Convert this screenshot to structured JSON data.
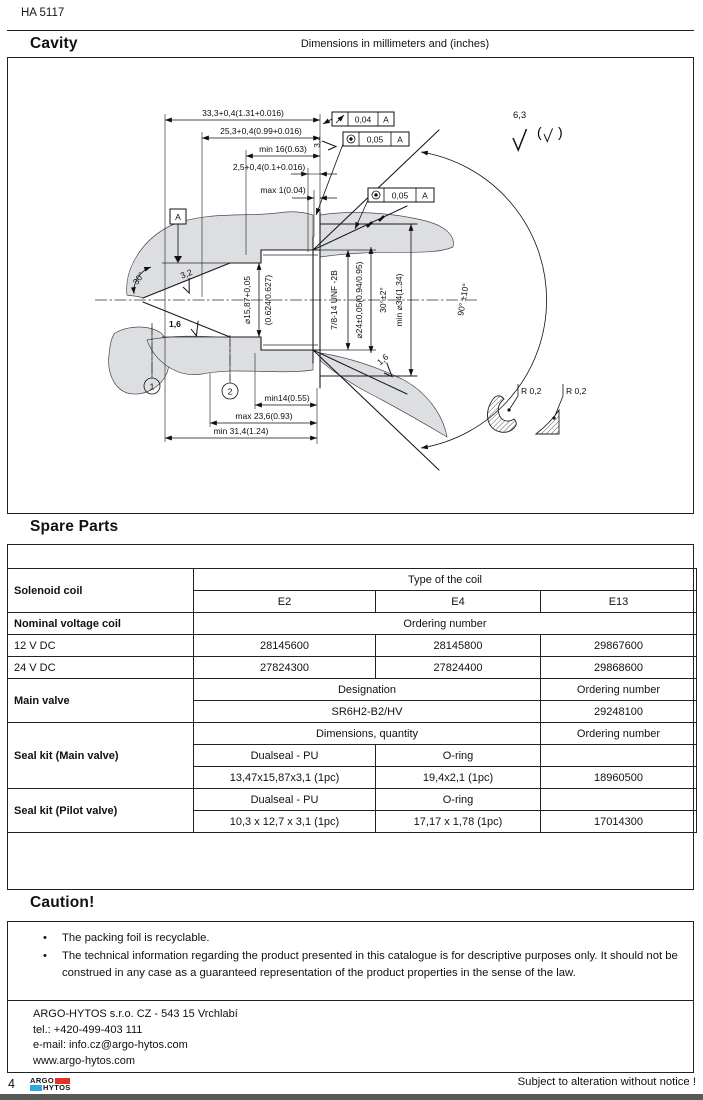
{
  "doc_code": "HA 5117",
  "cavity": {
    "title": "Cavity",
    "dims_note": "Dimensions in millimeters and (inches)"
  },
  "drawing": {
    "top1": "33,3+0,4(1.31+0.016)",
    "top2": "25,3+0,4(0.99+0.016)",
    "top3": "min 16(0.63)",
    "top4": "2,5+0,4(0.1+0.016)",
    "top5": "max 1(0.04)",
    "g1_val": "0,04",
    "g1_ref": "A",
    "g2_val": "0,05",
    "g2_ref": "A",
    "g3_val": "0,05",
    "g3_ref": "A",
    "datum": "A",
    "s32a": "3,2",
    "s32b": "3,2",
    "s16a": "1,6",
    "s16b": "1,6",
    "s63": "6,3",
    "bore1a": "⌀15,87+0,05",
    "bore1b": "(0.624/0.627)",
    "thread": "7/8-14 UNF  -2B",
    "bore2": "⌀24±0,05(0.94/0.95)",
    "cham30": "30°±2°",
    "bore3": "min ⌀34(1.34)",
    "cone90": "90° ±10°",
    "seat30": "30°",
    "bot1": "min14(0.55)",
    "bot2": "max 23,6(0.93)",
    "bot3": "min 31,4(1.24)",
    "r02a": "R 0,2",
    "r02b": "R 0,2",
    "bal1": "1",
    "bal2": "2"
  },
  "spare_parts": {
    "title": "Spare Parts",
    "rows": [
      [
        "Solenoid coil",
        "Type of the coil"
      ],
      [
        "E2",
        "E4",
        "E13"
      ],
      [
        "Nominal voltage coil",
        "Ordering number"
      ],
      [
        "12 V DC",
        "28145600",
        "28145800",
        "29867600"
      ],
      [
        "24 V DC",
        "27824300",
        "27824400",
        "29868600"
      ],
      [
        "Main valve",
        "Designation",
        "Ordering number"
      ],
      [
        "SR6H2-B2/HV",
        "29248100"
      ],
      [
        "Seal kit (Main valve)",
        "Dimensions, quantity",
        "Ordering number"
      ],
      [
        "Dualseal - PU",
        "O-ring",
        ""
      ],
      [
        "13,47x15,87x3,1 (1pc)",
        "19,4x2,1 (1pc)",
        "18960500"
      ],
      [
        "Seal kit (Pilot valve)",
        "Dualseal - PU",
        "O-ring",
        ""
      ],
      [
        "10,3 x 12,7 x 3,1 (1pc)",
        "17,17 x 1,78 (1pc)",
        "17014300"
      ]
    ]
  },
  "caution": {
    "title": "Caution!",
    "bullets": [
      "The packing foil is recyclable.",
      "The technical information regarding the product presented in this catalogue is for descriptive purposes only. It should not be construed in any case as a guaranteed representation of the product properties in the sense of the law."
    ]
  },
  "footer": {
    "contact": [
      "ARGO-HYTOS s.r.o. CZ - 543 15  Vrchlabí",
      "tel.: +420-499-403 111",
      "e-mail: info.cz@argo-hytos.com",
      "www.argo-hytos.com"
    ],
    "page_number": "4",
    "logo_top": "ARGO",
    "logo_bottom": "HYTOS",
    "notice": "Subject to alteration without notice !"
  }
}
